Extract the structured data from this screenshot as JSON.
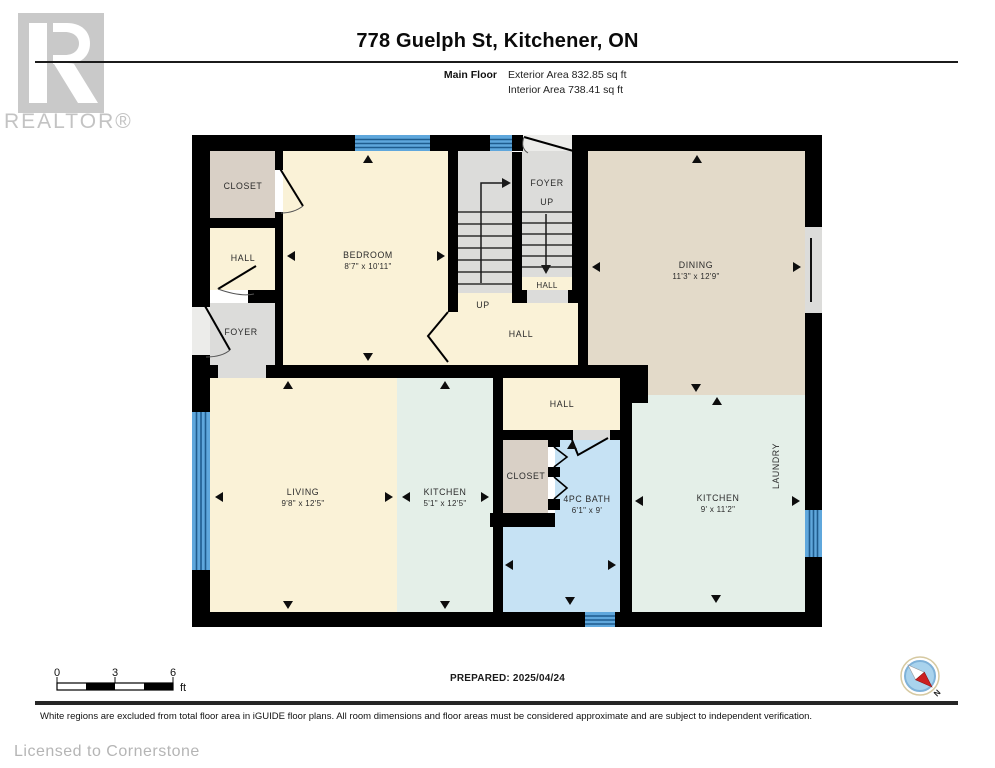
{
  "header": {
    "logo": {
      "text": "REALTOR®"
    },
    "title": "778 Guelph St, Kitchener, ON",
    "floor_label": "Main Floor",
    "exterior_area": "Exterior Area 832.85 sq ft",
    "interior_area": "Interior Area 738.41 sq ft"
  },
  "plan": {
    "rooms": [
      {
        "name": "CLOSET"
      },
      {
        "name": "HALL"
      },
      {
        "name": "FOYER"
      },
      {
        "name": "BEDROOM",
        "dims": "8'7\" x 10'11\""
      },
      {
        "name": "FOYER"
      },
      {
        "name": "UP"
      },
      {
        "name": "HALL"
      },
      {
        "name": "UP"
      },
      {
        "name": "HALL"
      },
      {
        "name": "DINING",
        "dims": "11'3\" x 12'9\""
      },
      {
        "name": "LIVING",
        "dims": "9'8\" x 12'5\""
      },
      {
        "name": "KITCHEN",
        "dims": "5'1\" x 12'5\""
      },
      {
        "name": "HALL"
      },
      {
        "name": "CLOSET"
      },
      {
        "name": "4PC BATH",
        "dims": "6'1\" x 9'"
      },
      {
        "name": "KITCHEN",
        "dims": "9' x 11'2\""
      },
      {
        "name": "LAUNDRY"
      }
    ]
  },
  "footer": {
    "scale_bar": {
      "labels": [
        "0",
        "3",
        "6"
      ],
      "unit": "ft"
    },
    "prepared": "PREPARED: 2025/04/24",
    "compass": {
      "label": "N"
    },
    "disclaimer": "White regions are excluded from total floor area in iGUIDE floor plans. All room dimensions and floor areas must be considered approximate and are subject to independent verification.",
    "license": "Licensed to Cornerstone"
  },
  "colors": {
    "wall": "#000000",
    "room_cream": "#FAF2D7",
    "room_tan": "#D9D0C6",
    "room_dining": "#E3DAC9",
    "room_gray": "#DCDCDA",
    "room_mint": "#E4EFE8",
    "room_bath": "#C6E2F4",
    "window_blue": "#5FA7DC",
    "window_line": "#1F5C8E",
    "logo_gray": "#C9C9C9"
  }
}
